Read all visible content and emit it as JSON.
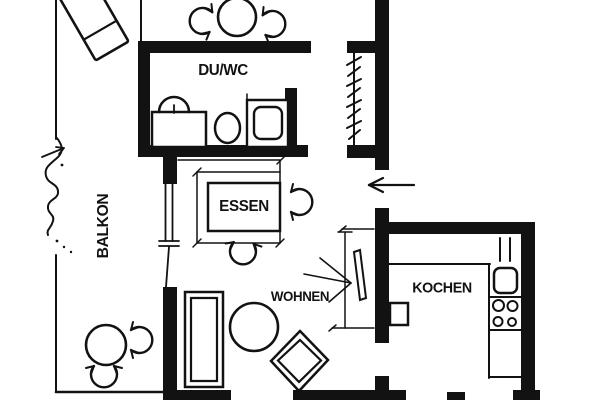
{
  "plan": {
    "type": "apartment-floorplan",
    "rooms": {
      "balkon": {
        "label": "BALKON"
      },
      "duwc": {
        "label": "DU/WC"
      },
      "essen": {
        "label": "ESSEN"
      },
      "wohnen": {
        "label": "WOHNEN"
      },
      "kochen": {
        "label": "KOCHEN"
      }
    },
    "colors": {
      "ink": "#121212",
      "paper": "#ffffff"
    }
  }
}
